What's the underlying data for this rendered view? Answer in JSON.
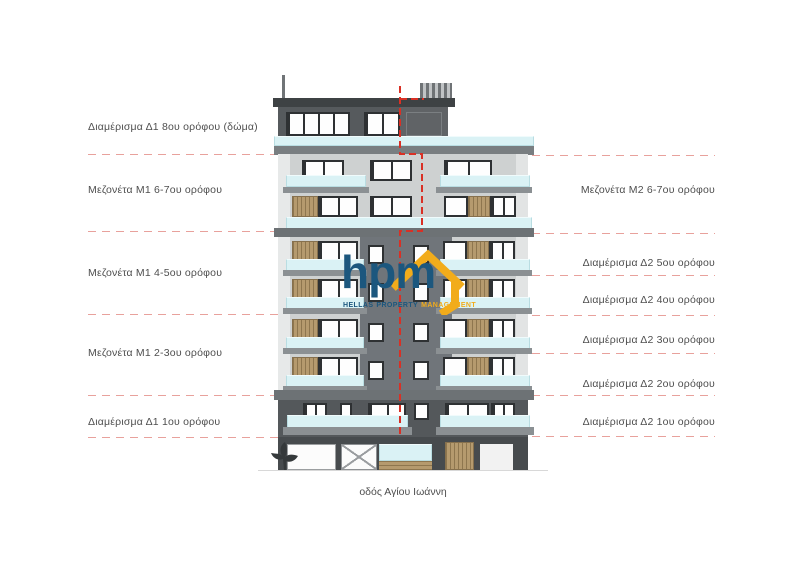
{
  "diagram": {
    "street_label": "οδός Αγίου Ιωάννη"
  },
  "left_labels": [
    {
      "label": "Διαμέρισμα Δ1 8ου ορόφου (δώμα)",
      "y": 127
    },
    {
      "label": "Μεζονέτα Μ1 6-7ου ορόφου",
      "y": 190
    },
    {
      "label": "Μεζονέτα Μ1 4-5ου ορόφου",
      "y": 273
    },
    {
      "label": "Μεζονέτα Μ1 2-3ου ορόφου",
      "y": 353
    },
    {
      "label": "Διαμέρισμα Δ1 1ου ορόφου",
      "y": 422
    }
  ],
  "right_labels": [
    {
      "label": "Μεζονέτα Μ2 6-7ου ορόφου",
      "y": 190
    },
    {
      "label": "Διαμέρισμα Δ2 5ου ορόφου",
      "y": 263
    },
    {
      "label": "Διαμέρισμα Δ2 4ου ορόφου",
      "y": 300
    },
    {
      "label": "Διαμέρισμα Δ2 3ου ορόφου",
      "y": 340
    },
    {
      "label": "Διαμέρισμα Δ2 2ου ορόφου",
      "y": 384
    },
    {
      "label": "Διαμέρισμα Δ2 1ου ορόφου",
      "y": 422
    }
  ],
  "left_floor_lines_y": [
    154,
    231,
    314,
    395,
    437
  ],
  "right_floor_lines_y": [
    155,
    233,
    275,
    315,
    353,
    395,
    436
  ],
  "logo": {
    "name": "hpm",
    "word1": "HELLAS",
    "word2": "PROPERTY",
    "word3": "MANAGEMENT"
  },
  "colors": {
    "logo_blue": "#1c577e",
    "logo_yellow": "#f2ac1b",
    "guide_line": "#e8a19c",
    "boundary_red": "#d93025",
    "glass_cyan": "#daf2f5",
    "wood": "#b59a6e"
  }
}
